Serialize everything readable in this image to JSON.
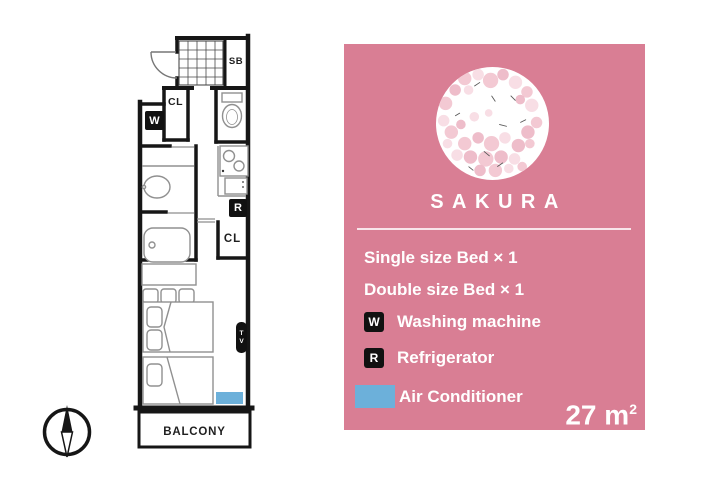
{
  "floorplan": {
    "labels": {
      "shoe_box": "SB",
      "closet_upper": "CL",
      "closet_lower": "CL",
      "washer_badge": "W",
      "fridge_badge": "R",
      "tv": "TV",
      "balcony": "BALCONY"
    },
    "colors": {
      "wall": "#161616",
      "fixture": "#909090",
      "ac_marker": "#6cb0da",
      "badge_bg": "#111111"
    }
  },
  "panel": {
    "title": "SAKURA",
    "bg_color": "#d97e94",
    "beds": {
      "single": "Single size Bed × 1",
      "double": "Double size Bed × 1"
    },
    "amenities": {
      "washing": {
        "badge": "W",
        "label": "Washing machine"
      },
      "fridge": {
        "badge": "R",
        "label": "Refrigerator"
      },
      "ac": {
        "label": "Air Conditioner",
        "swatch_color": "#6cb0da"
      }
    },
    "area": {
      "value": "27",
      "unit": "m",
      "sup": "2"
    }
  }
}
